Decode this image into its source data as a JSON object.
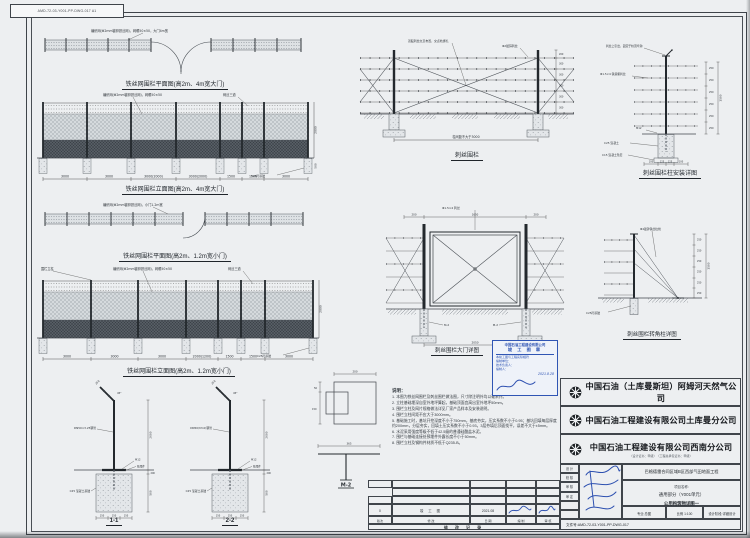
{
  "sheet": {
    "corner_label": "AMD-72-03-Y001-PP-DWG-017  A1"
  },
  "drawings": {
    "plan1": {
      "caption": "铁丝网围栏平面图(高2m、4m宽大门)",
      "note": "编织网(Φ2mm镀锌铁丝网)，网眼50×50，大门4m宽"
    },
    "elev1": {
      "caption": "铁丝网围栏立面图(高2m、4m宽大门)",
      "dims": [
        "3000",
        "3000",
        "3000(2000)",
        "3000(2000)",
        "1500",
        "1500",
        "3000"
      ],
      "hdim": "2000",
      "fdim": "500",
      "note_mesh": "编织网(Φ2mm镀锌铁丝网)，网眼50×50",
      "note_barb": "刺丝三道",
      "note_found": "C25砼基础"
    },
    "plan2": {
      "caption": "铁丝网围栏平面图(高2m、1.2m宽小门)",
      "note": "编织网(Φ2mm镀锌铁丝网)，小门1.2m宽"
    },
    "elev2": {
      "caption": "铁丝网围栏立面图(高2m、1.2m宽小门)",
      "dims": [
        "3000",
        "3000",
        "3000",
        "2000(1200)",
        "1500",
        "1500",
        "3000"
      ],
      "hdim": "2000",
      "note_mesh": "编织网(Φ2mm镀锌铁丝网)，网眼50×50",
      "note_barb": "刺丝三道",
      "note_found": "C25砼基础",
      "note_post": "围栏立柱"
    },
    "sections": {
      "s1": "1-1",
      "s2": "2-2",
      "post1": "DN50×3.25钢管",
      "post2": "DN50(δ3.0)钢管",
      "bolt": "M12",
      "plate": "预埋件",
      "found": "C25 混凝土基础",
      "arm": "250",
      "angle": "45°",
      "hdim": "2000",
      "gdim": "200",
      "fdim": "500",
      "bdims": [
        "150",
        "150",
        "150"
      ]
    },
    "barbed": {
      "caption": "刺丝围栏",
      "span": "柱间距不大于3000",
      "rdims": [
        "200",
        "300",
        "300",
        "300",
        "300",
        "300"
      ],
      "note1": "双股刺丝交叉布置，交点处绑扎",
      "note2": "Φ2镀锌刺丝"
    },
    "postd": {
      "caption": "刺丝围栏柱安装详图",
      "topnote": "刺丝上引出，固定于柱顶弯钩",
      "wire": "Φ1.5×4 铁蒺藜刺丝",
      "found": "C25 混凝土",
      "pad": "C15 混凝土垫层",
      "bolt": "M12",
      "rdims": [
        "250",
        "250",
        "250",
        "250",
        "250",
        "250"
      ],
      "total": "1500",
      "b": [
        "100",
        "125",
        "125",
        "100"
      ]
    },
    "gate": {
      "caption": "刺丝围栏大门详图",
      "wire": "Φ1.5×4 刺丝",
      "t1": "200",
      "t2": "1650",
      "t3": "200",
      "bdim": "2050",
      "tag": "M-2"
    },
    "cpost": {
      "caption": "刺丝围栏转角柱详图",
      "stay": "Φ4镀锌铁丝拉线",
      "found": "C25砼基础",
      "rdims": [
        "250",
        "250",
        "250",
        "250",
        "250",
        "250"
      ],
      "total": "1500"
    },
    "mdet": {
      "label": "M-2",
      "ttot": "200",
      "l1": "50",
      "l2": "150",
      "b1": "365"
    }
  },
  "notes": {
    "title": "说明：",
    "items": [
      "1. 本图为铁丝网围栏及刺丝围栏做法图，尺寸除注明外均以毫米计。",
      "2. 立柱基础埋深自室外地坪算起，基础顶面宜高出室外地坪50mm。",
      "3. 围栏立柱及网片规格做法详见厂家产品样本及安装说明。",
      "4. 围栏立柱间距不应大于3000mm。",
      "5. 基础施工时，基坑开挖深度不小于750mm，基底夯实，压实系数不小于0.95；基坑回填每层厚度约200mm，分层夯实，回填土压实系数不小于0.93，3层夯填后顶面找平，误差不大于±5mm。",
      "6. 水泥采用强度等级不低于42.5级的普通硅酸盐水泥。",
      "7. 围栏与基础连接处预埋件外露长度不小于50mm。",
      "8. 围栏立柱及钢构件材质不低于Q235-B。"
    ]
  },
  "stamp": {
    "l1": "中国石油工程建设有限公司",
    "l2": "竣 工 图 章",
    "l3": "本竣工图与工程实际相符",
    "l4": "编制单位：",
    "l5": "技术负责人：",
    "l6": "编制人：",
    "date": "2021.8.28"
  },
  "titleblock": {
    "c1": "中国石油（土库曼斯坦）阿姆河天然气公司",
    "c2": "中国石油工程建设有限公司土库曼分公司",
    "c3": "中国石油工程建设有限公司西南分公司",
    "cert": "（设计证书：甲级）　（工程总承包证书：甲级）",
    "sig_labels": [
      "设 计",
      "校 核",
      "审 核",
      "审 定"
    ],
    "project": "巴格德雷合同区域B区西部气田地面工程",
    "name_label": "项目名称:",
    "unit": "通用部分（Y001单元）",
    "title": "公用构筑物详图一",
    "major": "专业:总图",
    "scale": "比例 1:100",
    "stage": "设计阶段:详细设计",
    "docno": "文件号:AMD-72-03-Y001-PP-DWG-017"
  },
  "revtable": {
    "r": "0",
    "desc": "竣 工 图",
    "date": "2021.08",
    "l1": "版次",
    "l2": "修  改",
    "l3": "日 期",
    "l4": "编 制",
    "l5": "审 核",
    "footer": "修 改 记 录"
  },
  "colors": {
    "accent_blue": "#2d50b0",
    "line": "#40454b",
    "paper": "#edeff1"
  }
}
